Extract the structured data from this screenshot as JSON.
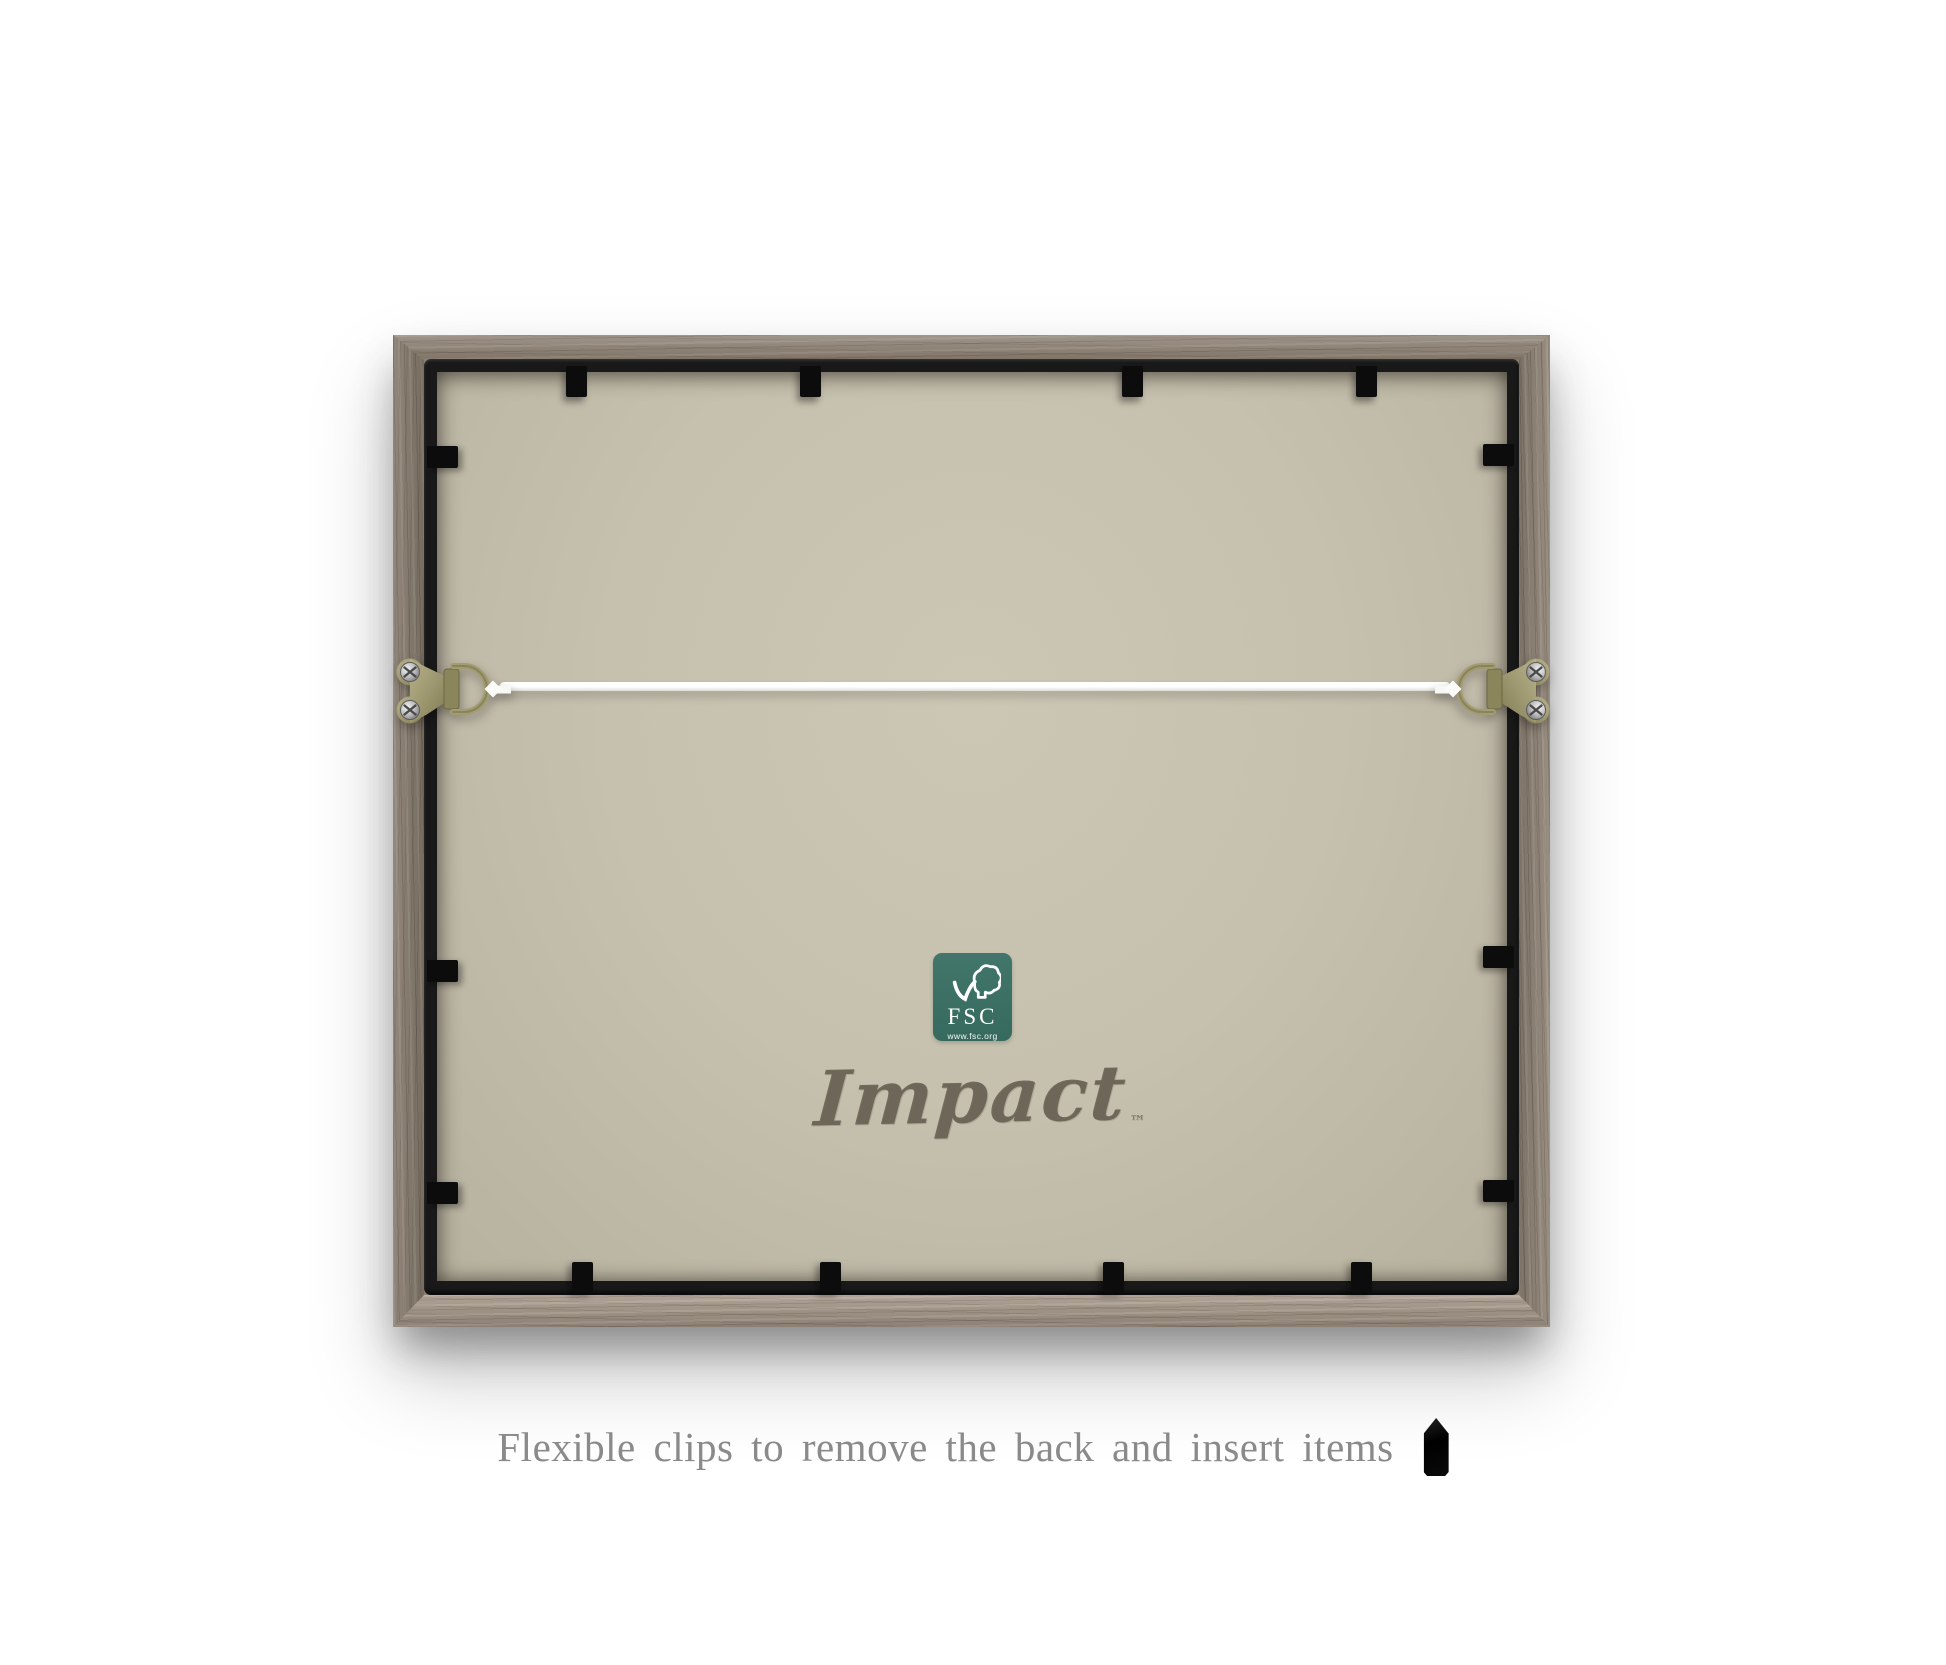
{
  "meta": {
    "description": "Back view of a wooden picture frame with flexible clips, D-ring hangers, hanging wire and FSC label",
    "background_color": "#ffffff"
  },
  "frame": {
    "wood_color": "#8c8071",
    "wood_color_bottom": "#a39585",
    "inner_border_color": "#191919",
    "backing_color": "#c6c0ae",
    "clip_color": "#0c0c0c",
    "clip_count": 12
  },
  "hardware": {
    "left_icon": "d-ring-hanger-icon",
    "right_icon": "d-ring-hanger-icon",
    "plate_color": "#a19a6f",
    "screw_color": "#c9c9c9",
    "wire_color": "#f7f7f4"
  },
  "fsc_label": {
    "acronym": "FSC",
    "url_text": "www.fsc.org",
    "background": "#3d7265",
    "icon": "fsc-tree-checkmark-icon"
  },
  "brand": {
    "name": "Impact",
    "trademark": "™",
    "color": "#7f7768"
  },
  "caption": {
    "text": "Flexible clips to remove the back and insert items",
    "color": "#8a8a8a",
    "icon": "flexible-clip-icon"
  }
}
